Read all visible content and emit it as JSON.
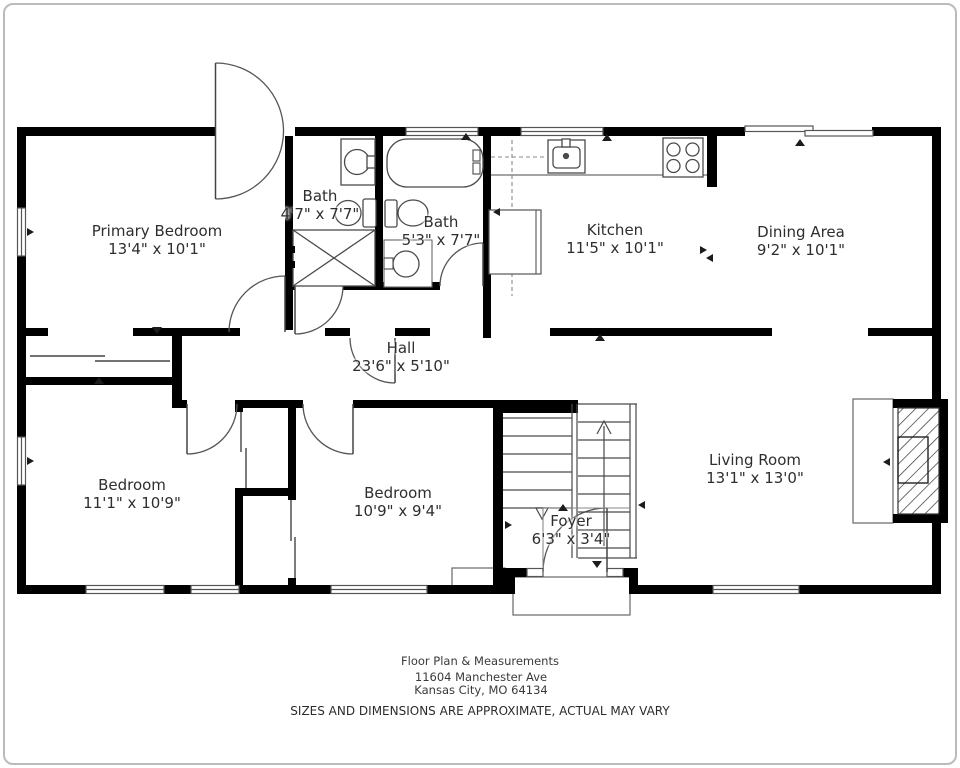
{
  "rooms": [
    {
      "id": "primary-bedroom",
      "name": "Primary Bedroom",
      "dims": "13'4\" x 10'1\""
    },
    {
      "id": "bath-1",
      "name": "Bath",
      "dims": "4'7\" x 7'7\""
    },
    {
      "id": "bath-2",
      "name": "Bath",
      "dims": "5'3\" x 7'7\""
    },
    {
      "id": "kitchen",
      "name": "Kitchen",
      "dims": "11'5\" x 10'1\""
    },
    {
      "id": "dining-area",
      "name": "Dining Area",
      "dims": "9'2\" x 10'1\""
    },
    {
      "id": "hall",
      "name": "Hall",
      "dims": "23'6\" x 5'10\""
    },
    {
      "id": "bedroom-left",
      "name": "Bedroom",
      "dims": "11'1\" x 10'9\""
    },
    {
      "id": "bedroom-middle",
      "name": "Bedroom",
      "dims": "10'9\" x 9'4\""
    },
    {
      "id": "foyer",
      "name": "Foyer",
      "dims": "6'3\" x 3'4\""
    },
    {
      "id": "living-room",
      "name": "Living Room",
      "dims": "13'1\" x 13'0\""
    }
  ],
  "footer": {
    "title": "Floor Plan & Measurements",
    "address_line1": "11604 Manchester Ave",
    "address_line2": "Kansas City, MO 64134",
    "disclaimer": "SIZES AND DIMENSIONS ARE APPROXIMATE, ACTUAL MAY VARY"
  },
  "colors": {
    "wall": "#000000",
    "fixture_line": "#4a4a4a",
    "text": "#2e2e2e",
    "frame": "#b7bcc1"
  }
}
